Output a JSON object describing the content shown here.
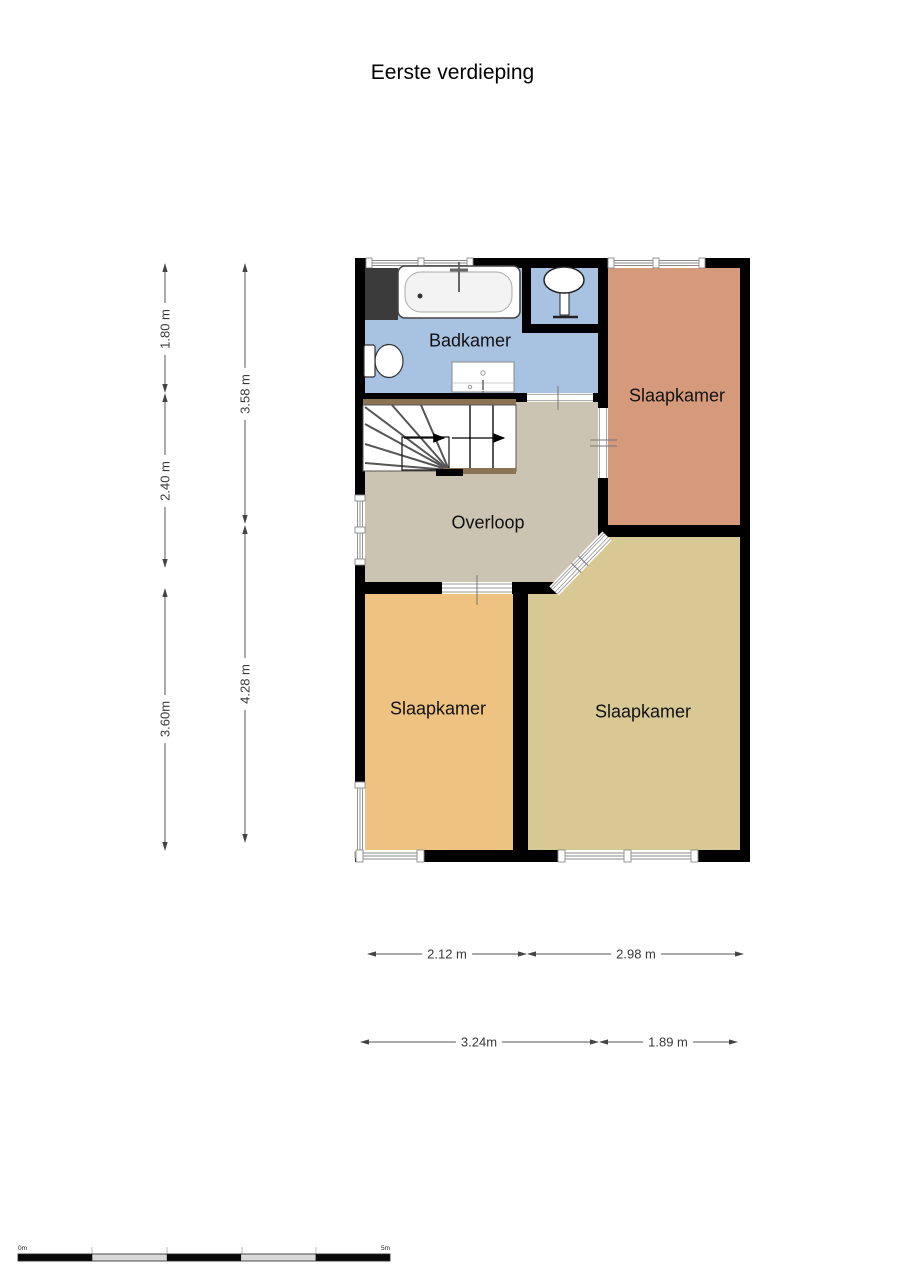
{
  "title": "Eerste verdieping",
  "rooms": {
    "badkamer": {
      "label": "Badkamer"
    },
    "slaapkamer_top_right": {
      "label": "Slaapkamer"
    },
    "overloop": {
      "label": "Overloop"
    },
    "slaapkamer_bottom_left": {
      "label": "Slaapkamer"
    },
    "slaapkamer_bottom_right": {
      "label": "Slaapkamer"
    }
  },
  "dimensions": {
    "left_outer": [
      {
        "label": "1.80 m"
      },
      {
        "label": "2.40 m"
      },
      {
        "label": "3.60m"
      }
    ],
    "left_inner": [
      {
        "label": "3.58 m"
      },
      {
        "label": "4.28 m"
      }
    ],
    "bottom_row1": [
      {
        "label": "2.12 m"
      },
      {
        "label": "2.98 m"
      }
    ],
    "bottom_row2": [
      {
        "label": "3.24m"
      },
      {
        "label": "1.89 m"
      }
    ]
  },
  "scale_bar": {
    "start_label": "0m",
    "end_label": "5m"
  },
  "colors": {
    "bathroom": "#a8c2e2",
    "bedroom_salmon": "#d59a7c",
    "bedroom_orange": "#eec381",
    "bedroom_khaki": "#d8c894",
    "landing": "#ccc4b2",
    "wall": "#000000",
    "stair_wood": "#8b7355",
    "closet_dark": "#3b3b3b"
  }
}
